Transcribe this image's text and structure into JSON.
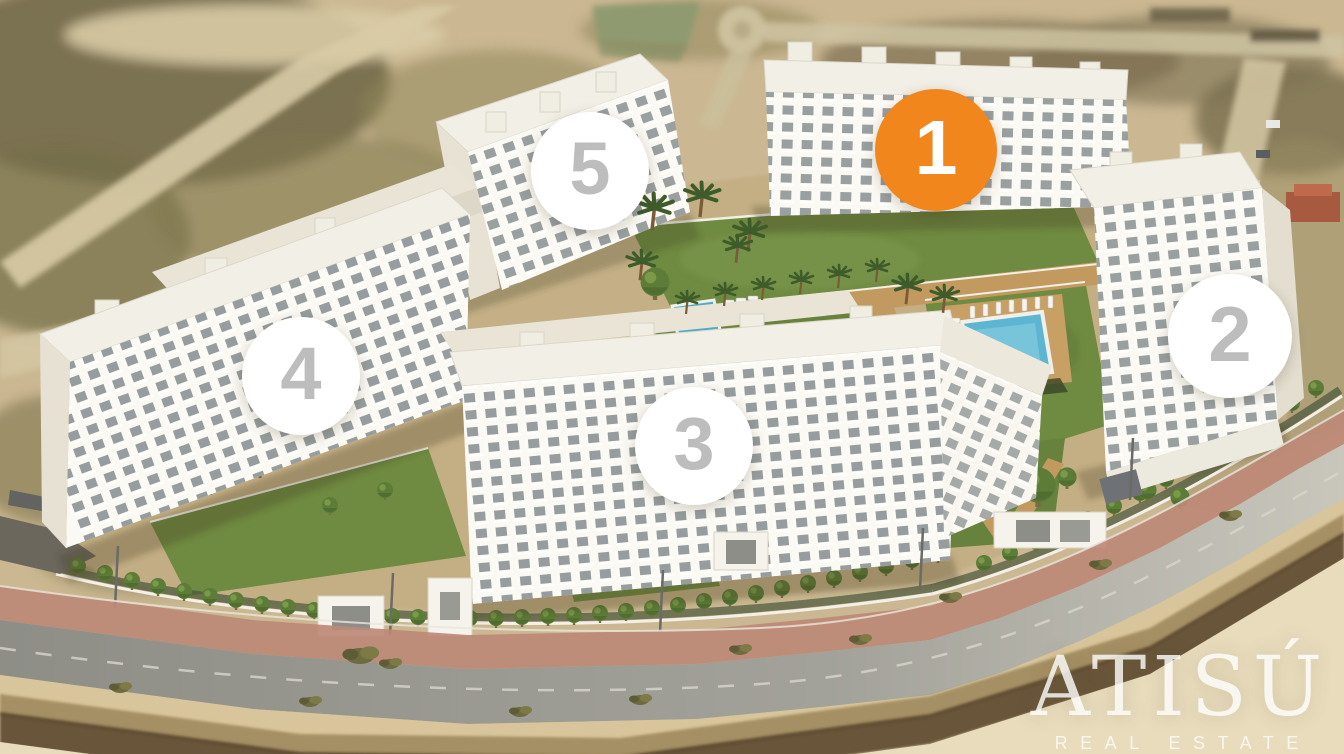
{
  "site_plan": {
    "markers": [
      {
        "label": "1",
        "state": "highlighted",
        "x": 936,
        "y": 150,
        "diameter": 122
      },
      {
        "label": "2",
        "state": "default",
        "x": 1230,
        "y": 336,
        "diameter": 124
      },
      {
        "label": "3",
        "state": "default",
        "x": 694,
        "y": 446,
        "diameter": 118
      },
      {
        "label": "4",
        "state": "default",
        "x": 301,
        "y": 376,
        "diameter": 118
      },
      {
        "label": "5",
        "state": "default",
        "x": 590,
        "y": 171,
        "diameter": 118
      }
    ],
    "colors": {
      "marker_highlight_bg": "#F1861D",
      "marker_highlight_text": "#FFFFFF",
      "marker_default_bg": "#FFFFFF",
      "marker_default_text": "#BDBDBD"
    }
  },
  "watermark": {
    "brand": "ATISÚ",
    "tagline": "REAL ESTATE"
  }
}
